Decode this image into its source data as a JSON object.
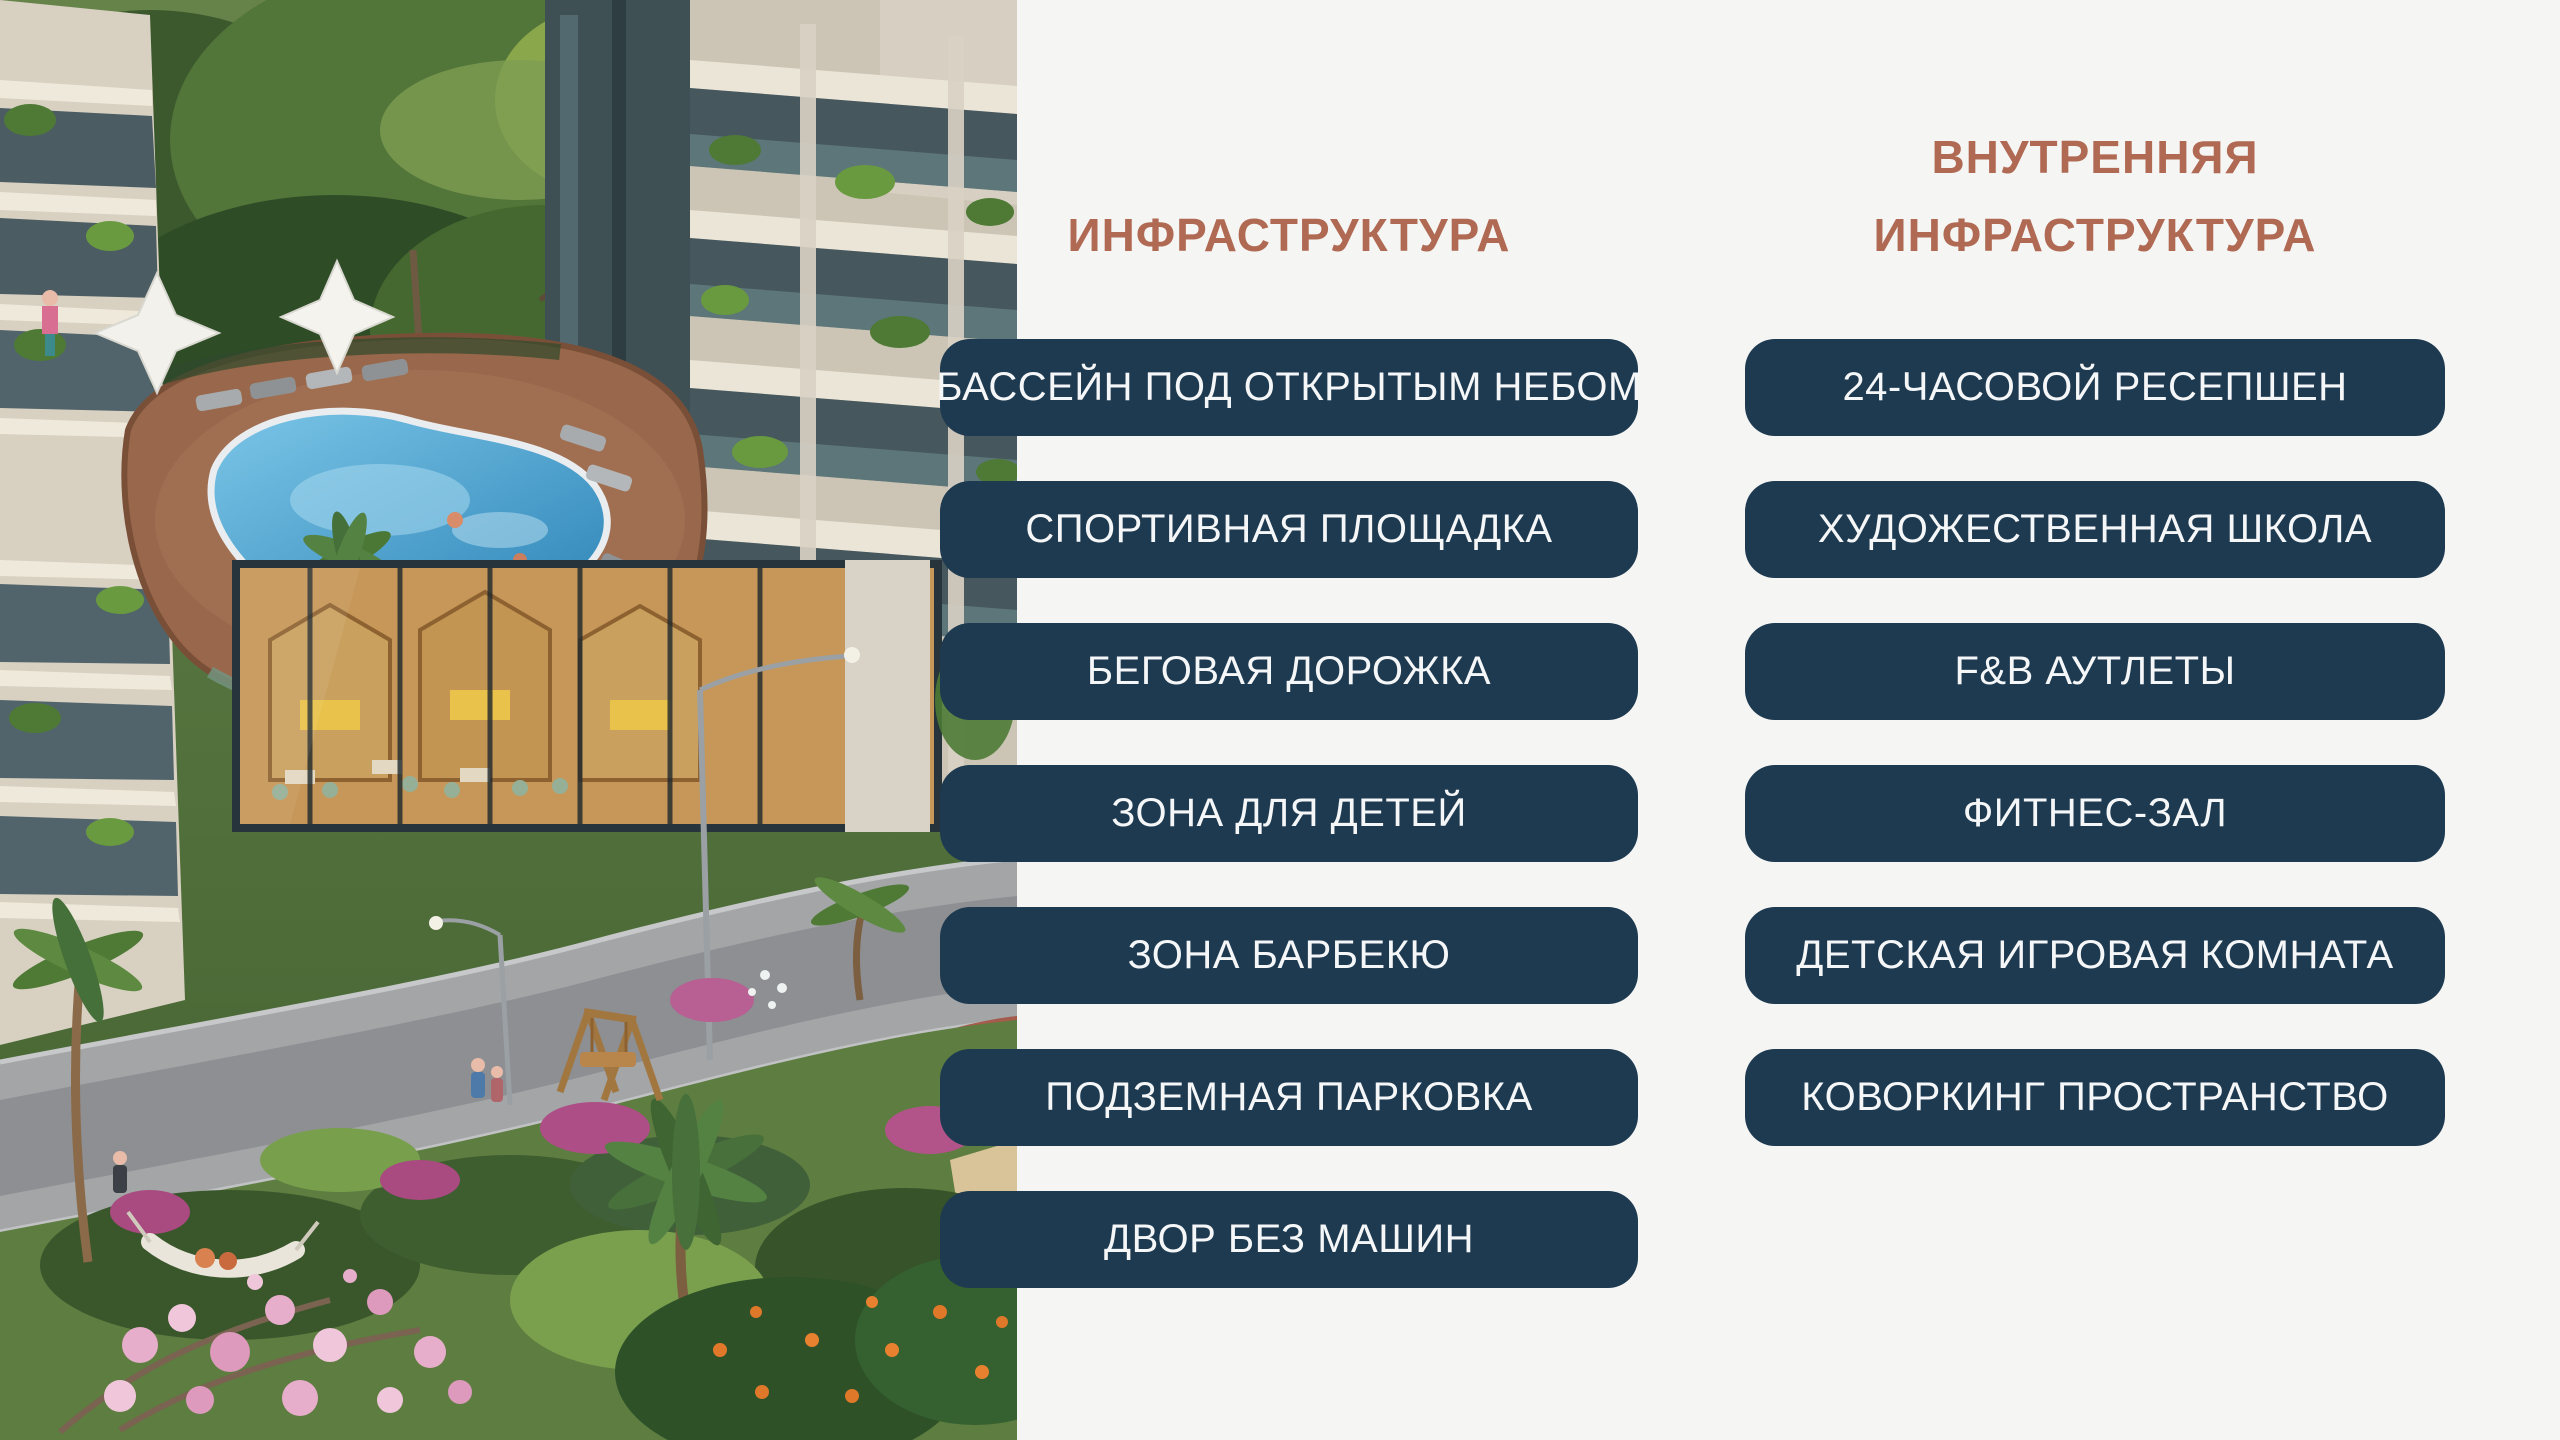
{
  "slide": {
    "background_color": "#f5f5f4",
    "heading_color": "#b06952",
    "pill_background_color": "#1e3a50",
    "pill_text_color": "#f4f6f7"
  },
  "photo": {
    "description": "Aerial render of a residential complex: outdoor pool terrace with white umbrellas and sun loungers between towers with glass balconies, a glass cafe with wooden booths below, a curved street with lamp posts, and gardens with palms, magnolia blossoms and orange trees"
  },
  "columns": [
    {
      "title_lines": [
        "ИНФРАСТРУКТУРА"
      ],
      "items": [
        "БАССЕЙН ПОД ОТКРЫТЫМ НЕБОМ",
        "СПОРТИВНАЯ ПЛОЩАДКА",
        "БЕГОВАЯ ДОРОЖКА",
        "ЗОНА ДЛЯ ДЕТЕЙ",
        "ЗОНА БАРБЕКЮ",
        "ПОДЗЕМНАЯ ПАРКОВКА",
        "ДВОР БЕЗ МАШИН"
      ]
    },
    {
      "title_lines": [
        "ВНУТРЕННЯЯ",
        "ИНФРАСТРУКТУРА"
      ],
      "items": [
        "24-ЧАСОВОЙ РЕСЕПШЕН",
        "ХУДОЖЕСТВЕННАЯ ШКОЛА",
        "F&B АУТЛЕТЫ",
        "ФИТНЕС-ЗАЛ",
        "ДЕТСКАЯ ИГРОВАЯ КОМНАТА",
        "КОВОРКИНГ ПРОСТРАНСТВО"
      ]
    }
  ]
}
